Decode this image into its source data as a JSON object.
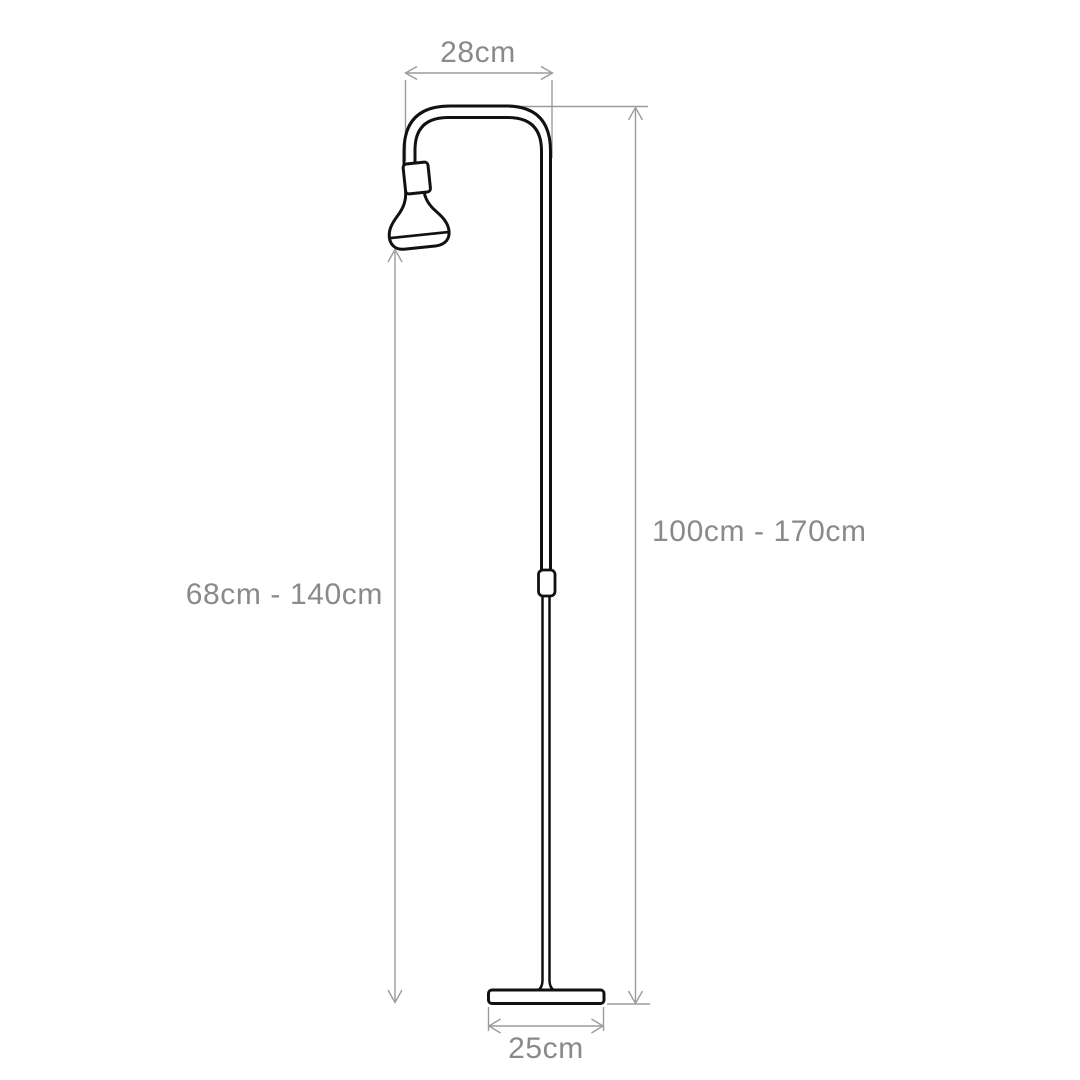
{
  "diagram": {
    "kind": "product dimension drawing",
    "subject": "adjustable arc floor lamp, side view",
    "background_color": "#ffffff",
    "outline_color": "#111111",
    "dimension_line_color": "#9b9b9b",
    "label_color": "#8a8a8a",
    "dims": {
      "arm_width": {
        "label": "28cm",
        "measures": "horizontal reach of curved arm"
      },
      "total_height": {
        "label": "100cm - 170cm",
        "measures": "overall height from floor to top of arm"
      },
      "head_height": {
        "label": "68cm - 140cm",
        "measures": "height from floor to bottom of lamp head"
      },
      "base_width": {
        "label": "25cm",
        "measures": "width of base plate"
      }
    },
    "parts": [
      "curved arm tube",
      "lamp socket",
      "reflector bulb head",
      "upper pole",
      "telescopic joint",
      "lower pole",
      "base plate"
    ]
  }
}
